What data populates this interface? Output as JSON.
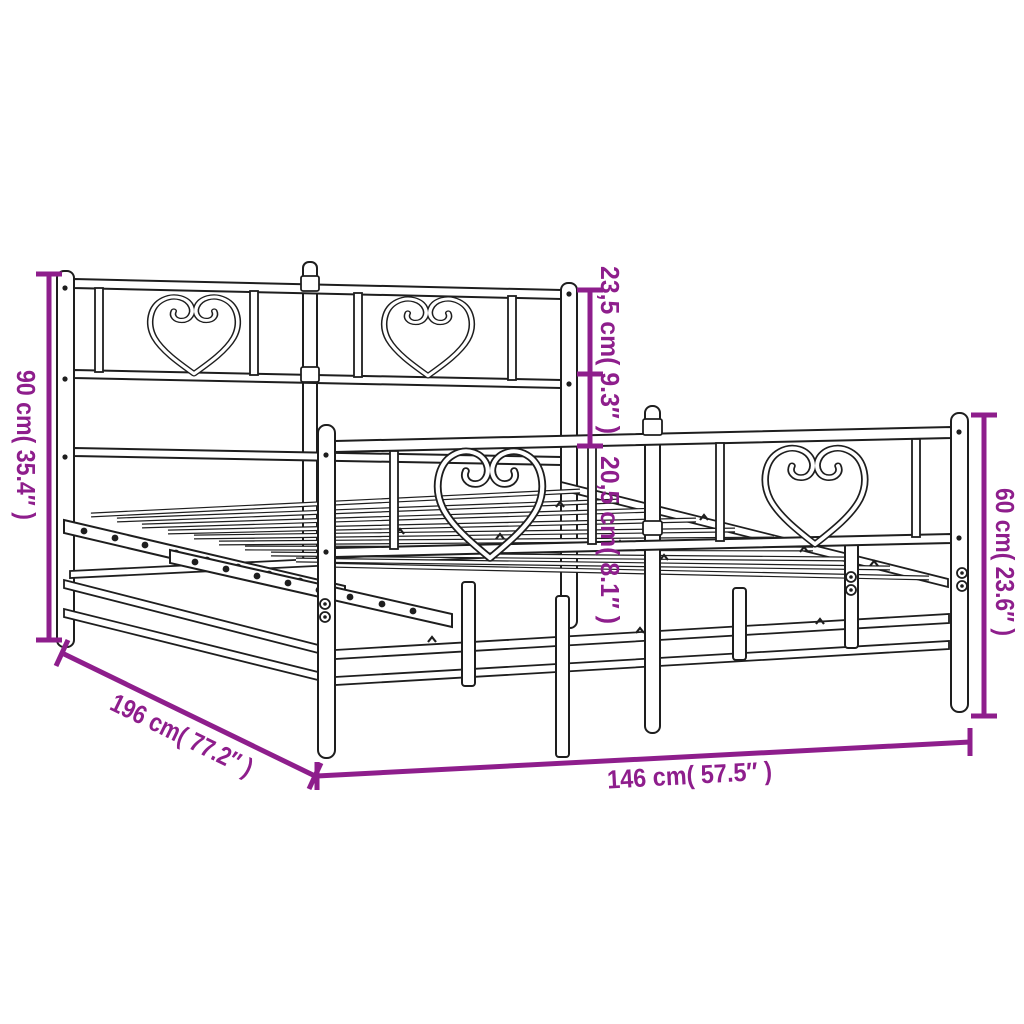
{
  "diagram": {
    "subject": "Metal bed frame with headboard and footboard - dimension drawing",
    "background": "#ffffff",
    "line_color": "#1e1e1e",
    "accent_color": "#8E1E8C"
  },
  "dimensions": {
    "overall_height": {
      "label": "90 cm( 35.4″ )",
      "cm": "90",
      "inch": "35.4"
    },
    "headboard_upper": {
      "label": "23,5 cm( 9.3″ )",
      "cm": "23,5",
      "inch": "9.3"
    },
    "headboard_lower": {
      "label": "20,5 cm( 8.1″ )",
      "cm": "20,5",
      "inch": "8.1"
    },
    "footboard_height": {
      "label": "60 cm( 23.6″ )",
      "cm": "60",
      "inch": "23.6"
    },
    "width": {
      "label": "146 cm( 57.5″ )",
      "cm": "146",
      "inch": "57.5"
    },
    "length": {
      "label": "196 cm( 77.2″ )",
      "cm": "196",
      "inch": "77.2"
    }
  }
}
